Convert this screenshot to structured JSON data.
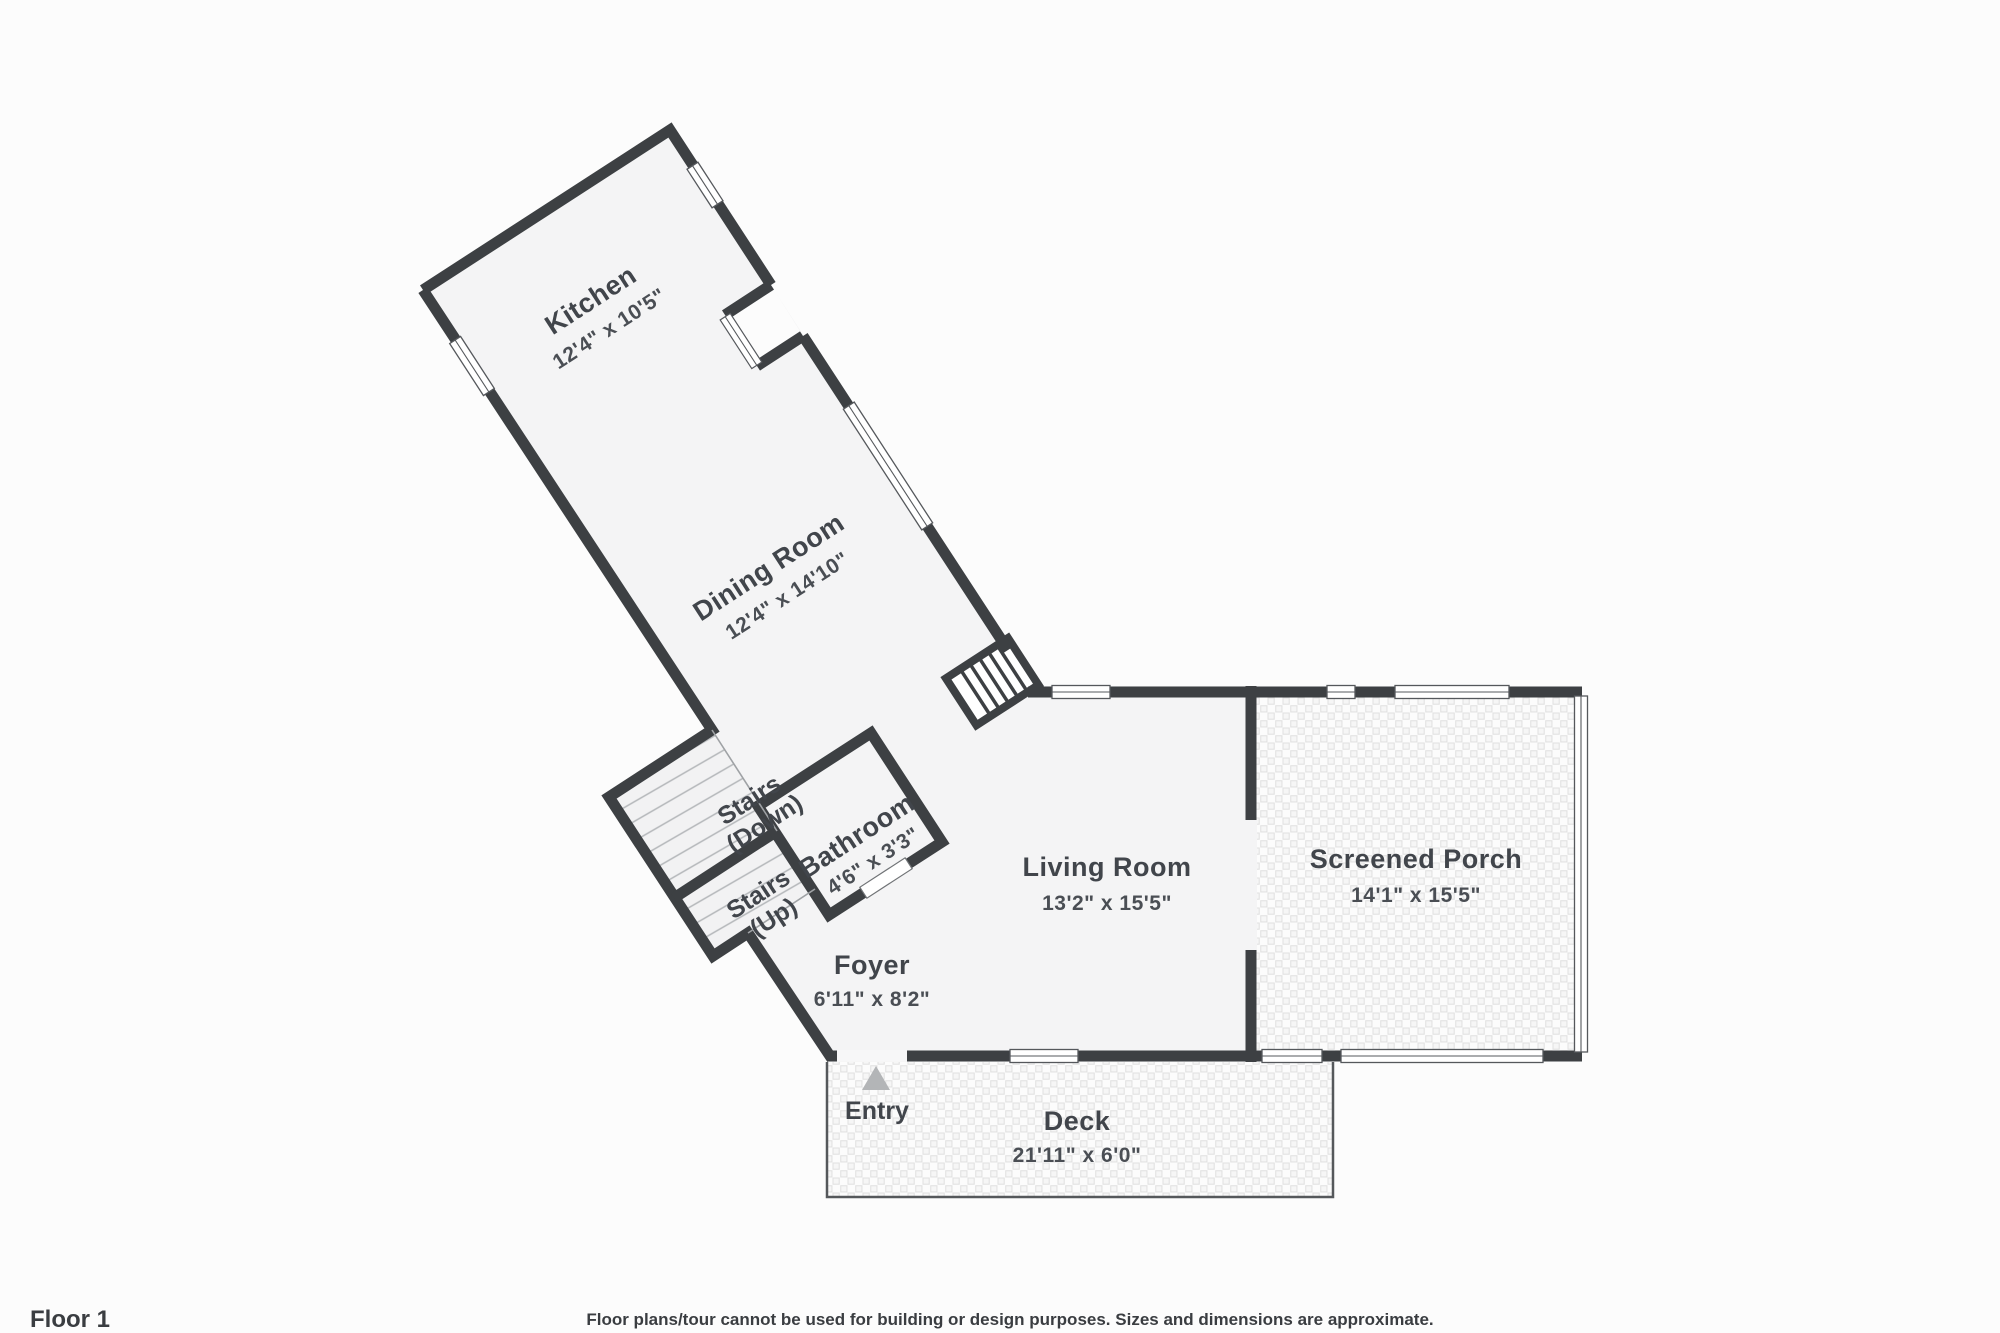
{
  "floor": {
    "label": "Floor 1"
  },
  "disclaimer": "Floor plans/tour cannot be used for building or design purposes. Sizes and dimensions are approximate.",
  "colors": {
    "wall": "#3d4043",
    "floor": "#f4f4f5",
    "background": "#fcfcfc",
    "hatch_line": "#b4b7ba",
    "tile_line": "#e0e0e0",
    "entry_arrow": "#b3b5b7",
    "text": "#41454b"
  },
  "rooms": {
    "kitchen": {
      "name": "Kitchen",
      "dims": "12'4\" x 10'5\""
    },
    "dining": {
      "name": "Dining Room",
      "dims": "12'4\" x 14'10\""
    },
    "stairs_down": {
      "line1": "Stairs",
      "line2": "(Down)"
    },
    "stairs_up": {
      "line1": "Stairs",
      "line2": "(Up)"
    },
    "bathroom": {
      "name": "Bathroom",
      "dims": "4'6\" x 3'3\""
    },
    "foyer": {
      "name": "Foyer",
      "dims": "6'11\" x 8'2\""
    },
    "living_room": {
      "name": "Living Room",
      "dims": "13'2\" x 15'5\""
    },
    "screened_porch": {
      "name": "Screened Porch",
      "dims": "14'1\" x 15'5\""
    },
    "deck": {
      "name": "Deck",
      "dims": "21'11\" x 6'0\""
    },
    "entry": {
      "name": "Entry"
    }
  }
}
